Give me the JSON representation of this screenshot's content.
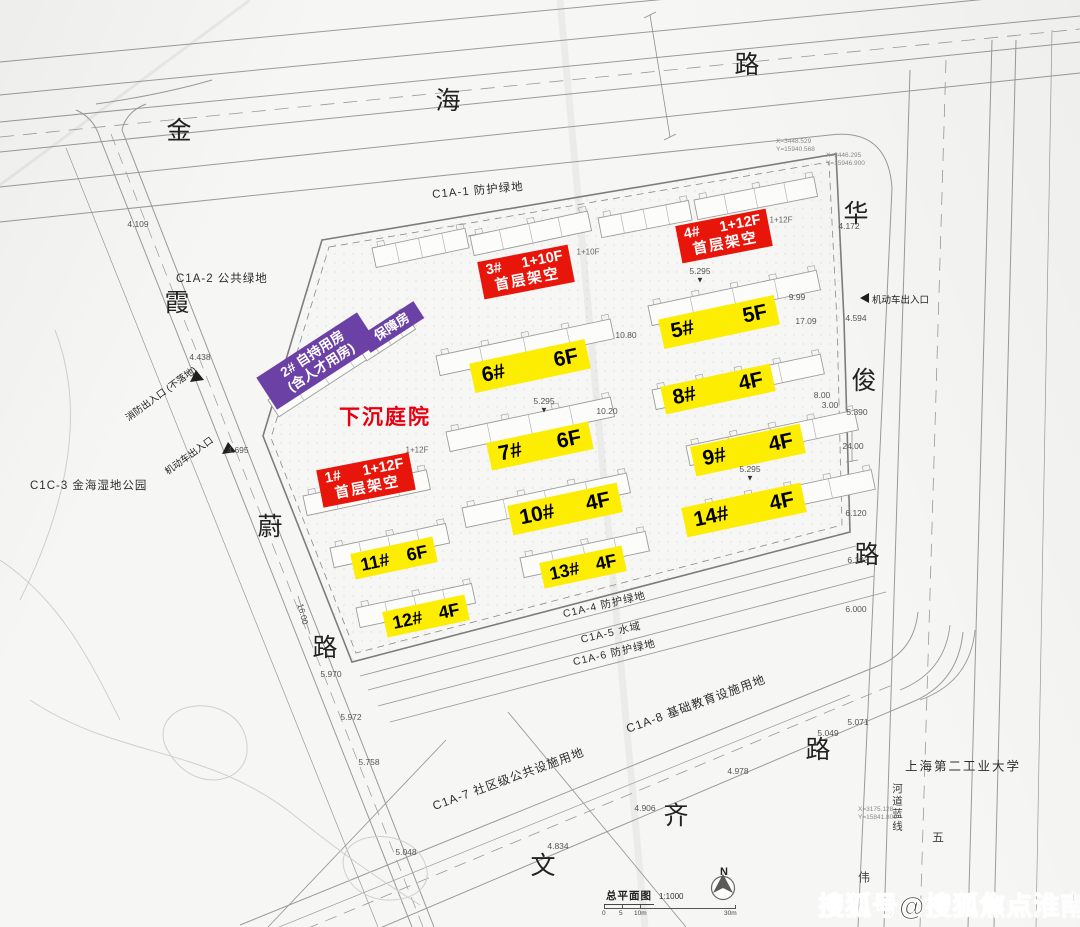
{
  "roads": {
    "jinhai": [
      "金",
      "海",
      "路"
    ],
    "xiawei": [
      "霞",
      "蔚",
      "路"
    ],
    "huajun": [
      "华",
      "俊",
      "路"
    ],
    "wenqi": [
      "文",
      "齐",
      "路"
    ],
    "far": [
      "五",
      "伟"
    ]
  },
  "parcels": [
    "C1A-1 防护绿地",
    "C1A-2 公共绿地",
    "C1C-3 金海湿地公园",
    "C1A-4 防护绿地",
    "C1A-5 水域",
    "C1A-6 防护绿地",
    "C1A-7 社区级公共设施用地",
    "C1A-8 基础教育设施用地"
  ],
  "landmark": "上海第二工业大学",
  "waterline": "河道蓝线",
  "courtyard": "下沉庭院",
  "purple": {
    "main_line1": "2# 自持用房",
    "main_line2": "(含人才用房)",
    "aux": "保障房"
  },
  "red_buildings": [
    {
      "num": "1#",
      "floors": "1+12F",
      "note": "首层架空"
    },
    {
      "num": "3#",
      "floors": "1+10F",
      "note": "首层架空"
    },
    {
      "num": "4#",
      "floors": "1+12F",
      "note": "首层架空"
    }
  ],
  "yellow_buildings": [
    {
      "num": "5#",
      "floors": "5F"
    },
    {
      "num": "6#",
      "floors": "6F"
    },
    {
      "num": "7#",
      "floors": "6F"
    },
    {
      "num": "8#",
      "floors": "4F"
    },
    {
      "num": "9#",
      "floors": "4F"
    },
    {
      "num": "10#",
      "floors": "4F"
    },
    {
      "num": "11#",
      "floors": "6F"
    },
    {
      "num": "12#",
      "floors": "4F"
    },
    {
      "num": "13#",
      "floors": "4F"
    },
    {
      "num": "14#",
      "floors": "4F"
    }
  ],
  "entrances": [
    "消防出入口 (不落地)",
    "机动车出入口",
    "机动车出入口"
  ],
  "floor_notes": [
    "1+10F",
    "1+12F",
    "1+12F"
  ],
  "elevations": [
    {
      "v": "4.109"
    },
    {
      "v": "4.438"
    },
    {
      "v": "4.695"
    },
    {
      "v": "5.970"
    },
    {
      "v": "5.972"
    },
    {
      "v": "5.758"
    },
    {
      "v": "5.048"
    },
    {
      "v": "4.834"
    },
    {
      "v": "4.906"
    },
    {
      "v": "4.978"
    },
    {
      "v": "5.049"
    },
    {
      "v": "5.071"
    },
    {
      "v": "6.000"
    },
    {
      "v": "6.193"
    },
    {
      "v": "6.120"
    },
    {
      "v": "24.00"
    },
    {
      "v": "5.390"
    },
    {
      "v": "4.594"
    },
    {
      "v": "4.172"
    },
    {
      "v": "9.99"
    },
    {
      "v": "17.09"
    },
    {
      "v": "8.00"
    },
    {
      "v": "3.00"
    },
    {
      "v": "5.295"
    },
    {
      "v": "5.295"
    },
    {
      "v": "5.295"
    },
    {
      "v": "10.80"
    },
    {
      "v": "10.20"
    },
    {
      "v": "16.00"
    }
  ],
  "coords": [
    [
      "X=3448.529",
      "Y=15940.568"
    ],
    [
      "X=3446.295",
      "Y=15946.900"
    ],
    [
      "X=3175.128",
      "Y=15841.800"
    ]
  ],
  "titleblock": {
    "title": "总平面图",
    "scale": "1:1000",
    "north": "N",
    "ticks": [
      "0",
      "5",
      "10m",
      "30m"
    ]
  },
  "watermark": "搜狐号@搜狐焦点淮南站"
}
